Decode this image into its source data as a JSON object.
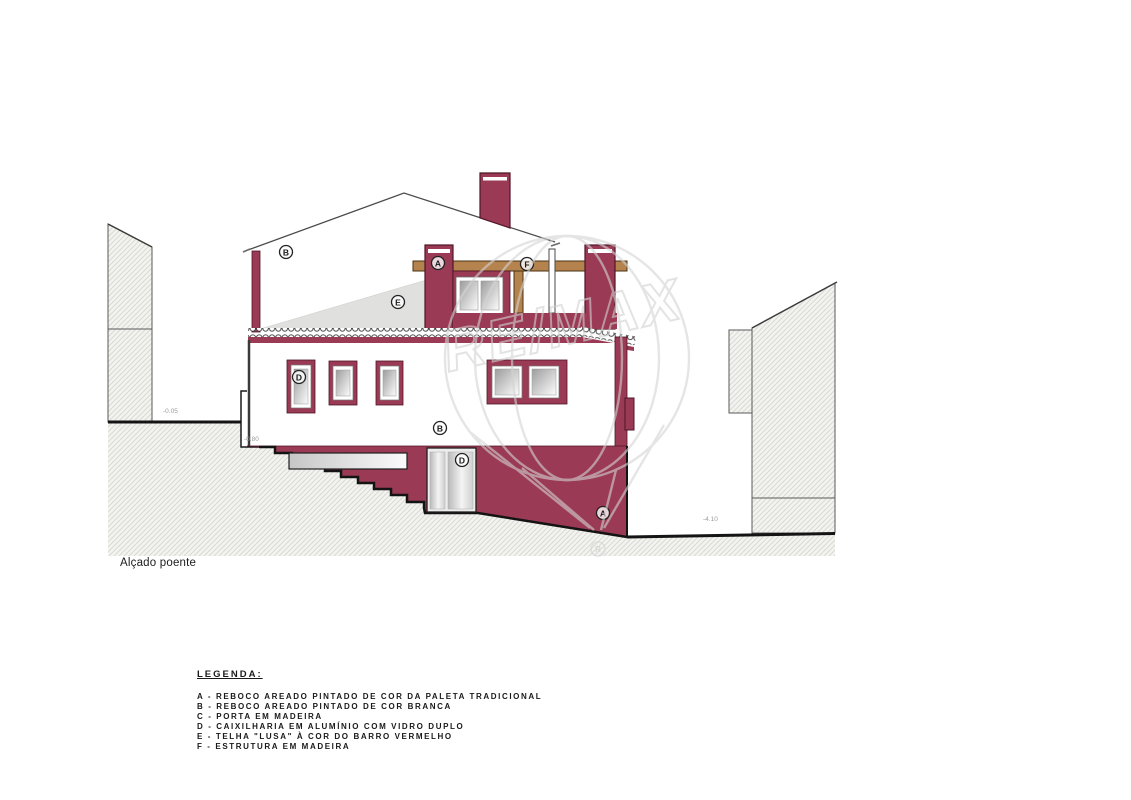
{
  "title": "Alçado poente",
  "legend": {
    "heading": "LEGENDA:",
    "items": [
      "A - REBOCO AREADO PINTADO DE COR DA PALETA TRADICIONAL",
      "B - REBOCO AREADO PINTADO DE COR BRANCA",
      "C - PORTA EM MADEIRA",
      "D - CAIXILHARIA EM ALUMÍNIO COM VIDRO DUPLO",
      "E - TELHA \"LUSA\" À COR DO BARRO VERMELHO",
      "F - ESTRUTURA EM MADEIRA"
    ]
  },
  "markers": {
    "gable_render": "B",
    "roof_tile": "E",
    "pillar_render": "A",
    "timber_beam": "F",
    "window_frame": "D",
    "wall_render": "B",
    "door_frame": "D",
    "base_render": "A"
  },
  "levels": {
    "street": "-0.05",
    "steps_top": "-0.80",
    "lower_ground": "-4.10"
  },
  "watermark": {
    "brand": "RE/MAX",
    "registered": "R"
  },
  "colors": {
    "maroon": "#9a3a54",
    "maroon_outline": "#4f1628",
    "wood": "#b5834e",
    "roof_grey": "#e0e0de",
    "hatch_grey": "#dcdcd8",
    "watermark_grey": "#d4d4d4",
    "ground_line": "#141414"
  }
}
